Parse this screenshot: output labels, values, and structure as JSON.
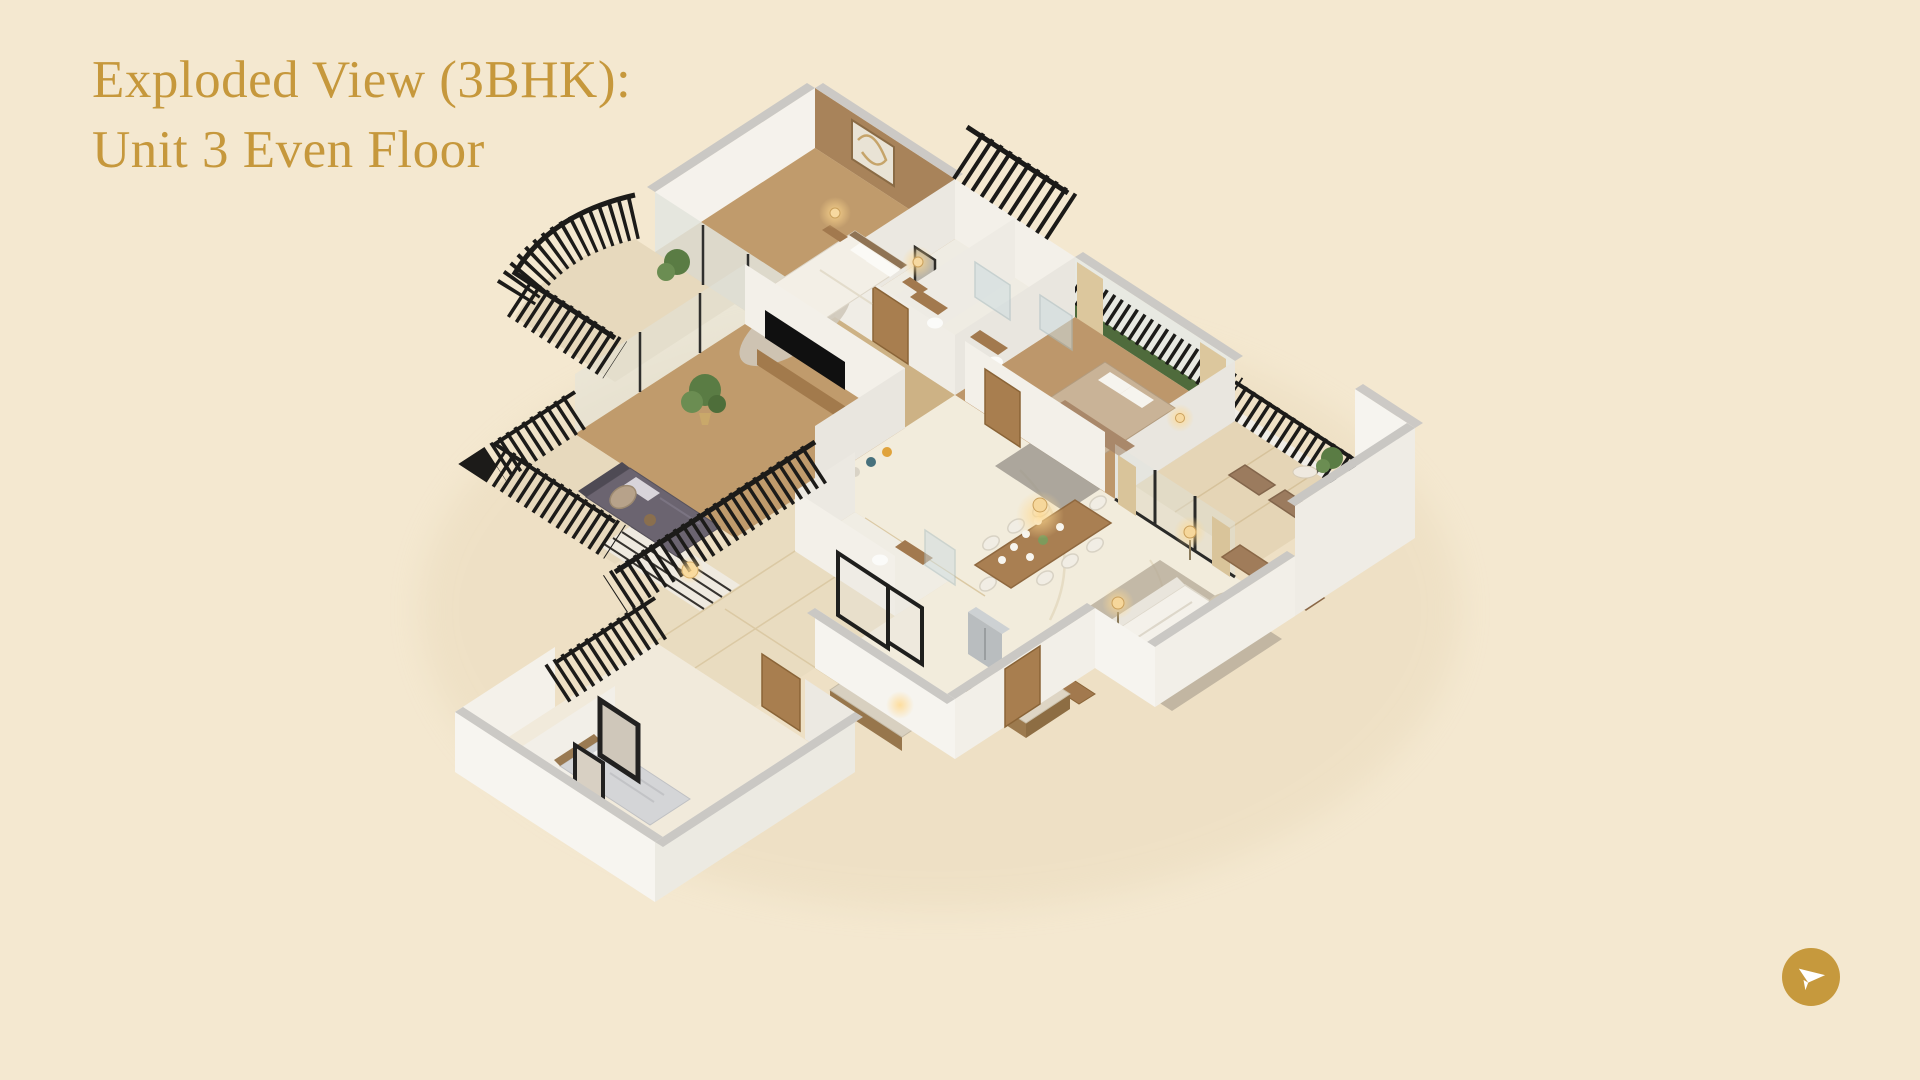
{
  "header": {
    "title_line1": "Exploded View (3BHK):",
    "title_line2": "Unit 3 Even Floor"
  },
  "action_button": {
    "icon": "paper-plane-send-icon"
  },
  "theme": {
    "bg": "#f4e8d0",
    "accent": "#c6983c",
    "button-gold": "#c6993d",
    "railing-black": "#1c1b19",
    "wall-white": "#f5f3ee",
    "wall-cap-grey": "#cac8c4",
    "wood-floor": "#c09b6c",
    "marble-floor": "#f2ecdc",
    "balcony-tile": "#e7d9bd"
  }
}
